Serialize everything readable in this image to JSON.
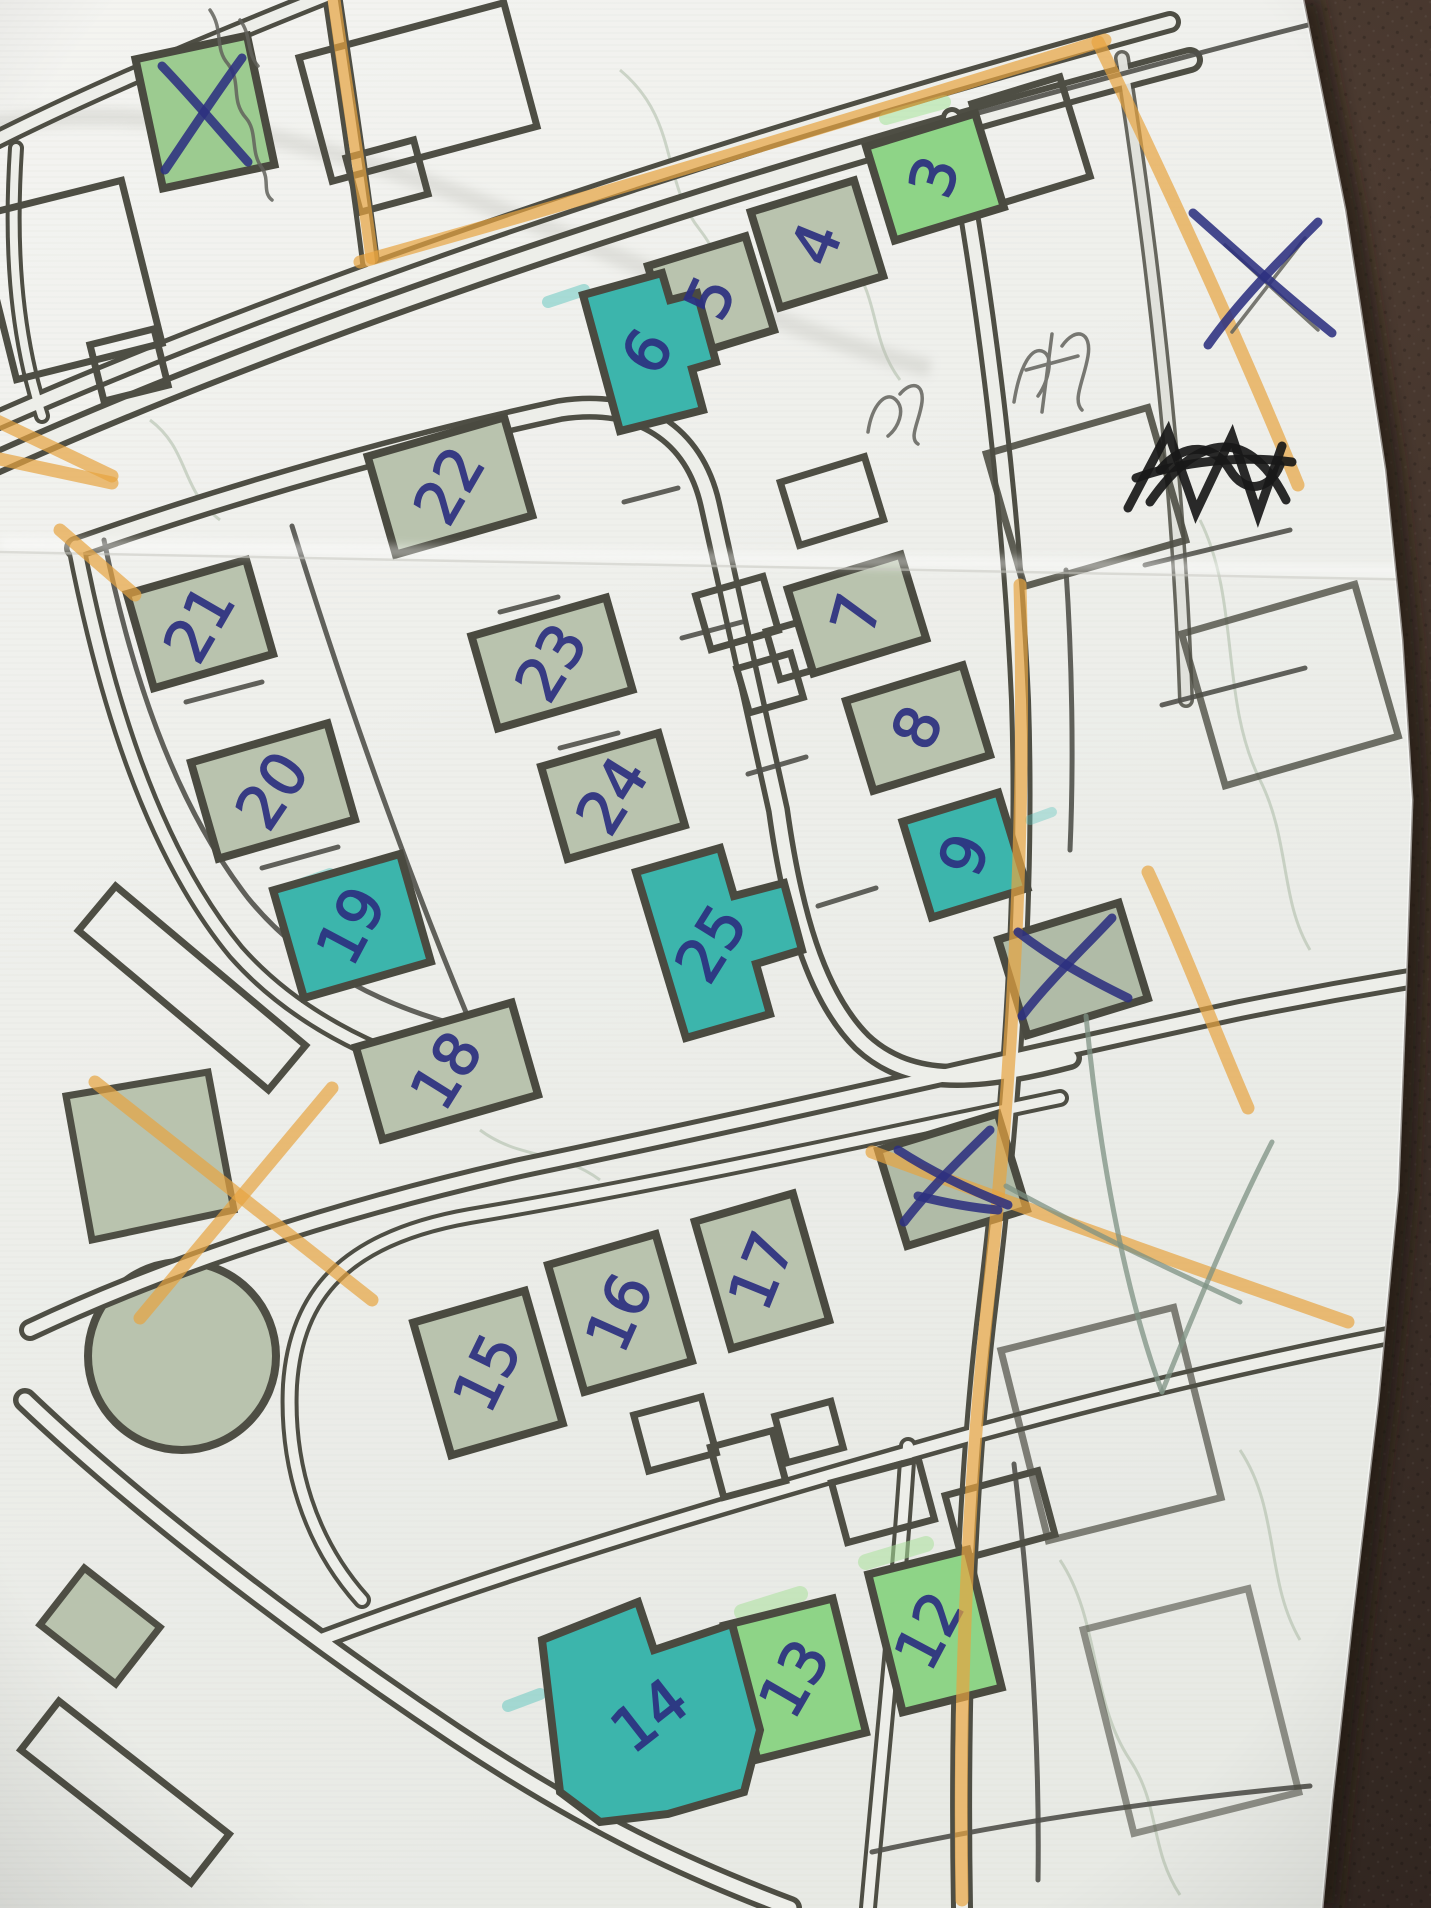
{
  "scene": {
    "type": "photo of a hand-annotated printed street map lying on a dark leather surface",
    "paper_color": "#eff0ec",
    "leather_color": "#3b2e27",
    "street_outline_color": "#4e4e44",
    "building_fill_color": "#b9c3ae",
    "pen_color": "#2c3080",
    "pencil_color": "#62625c",
    "highlighter_orange": "#e7a440",
    "marker_teal": "#3cb5ac",
    "marker_green": "#8ed487"
  },
  "map": {
    "buildings": [
      {
        "label": "3",
        "highlight": "green"
      },
      {
        "label": "4",
        "highlight": "none"
      },
      {
        "label": "5",
        "highlight": "none"
      },
      {
        "label": "6",
        "highlight": "teal"
      },
      {
        "label": "7",
        "highlight": "none"
      },
      {
        "label": "8",
        "highlight": "none"
      },
      {
        "label": "9",
        "highlight": "teal"
      },
      {
        "label": "22",
        "highlight": "none"
      },
      {
        "label": "23",
        "highlight": "none"
      },
      {
        "label": "24",
        "highlight": "none"
      },
      {
        "label": "25",
        "highlight": "teal"
      },
      {
        "label": "21",
        "highlight": "none"
      },
      {
        "label": "20",
        "highlight": "none"
      },
      {
        "label": "19",
        "highlight": "teal"
      },
      {
        "label": "18",
        "highlight": "none"
      },
      {
        "label": "17",
        "highlight": "none"
      },
      {
        "label": "16",
        "highlight": "none"
      },
      {
        "label": "15",
        "highlight": "none"
      },
      {
        "label": "12",
        "highlight": "green"
      },
      {
        "label": "13",
        "highlight": "green"
      },
      {
        "label": "14",
        "highlight": "teal"
      }
    ],
    "x_marks": [
      "top-left building",
      "building beside 9",
      "building south-east of 17",
      "paper margin top-right",
      "orange cross near park"
    ],
    "scribbles": [
      "pencil scribble",
      "pencil scribble",
      "black pen scratch-out",
      "pencil handwriting top edge",
      "green pencil arrow"
    ]
  }
}
